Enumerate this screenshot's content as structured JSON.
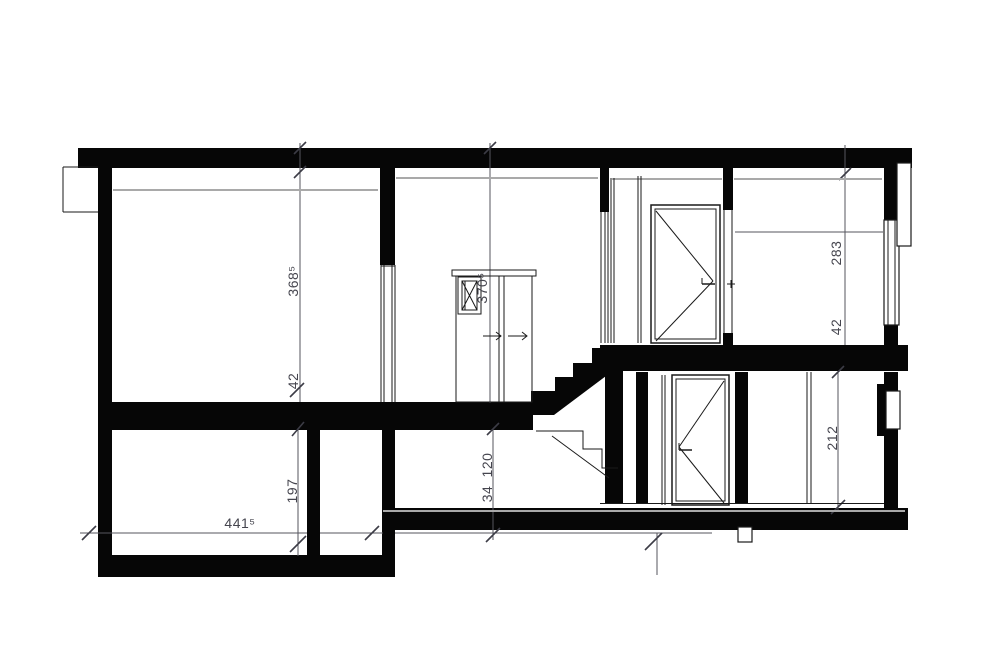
{
  "drawing": {
    "kind": "building-section",
    "colors": {
      "wall_cut": "#060606",
      "ceiling_line": "#a9a9a9",
      "dimension_line": "#55555e",
      "dimension_text": "#45454e",
      "background": "#ffffff"
    },
    "dimensions": {
      "upper_left_room_height": "368⁵",
      "upper_left_slab_thickness": "42",
      "stair_hall_height": "370⁵",
      "upper_right_room_height": "283",
      "upper_right_slab_thickness": "42",
      "lower_right_room_height": "212",
      "crawl_space_height": "120",
      "crawl_slab_thickness": "34",
      "basement_room_height": "197",
      "basement_width": "441⁵"
    }
  }
}
